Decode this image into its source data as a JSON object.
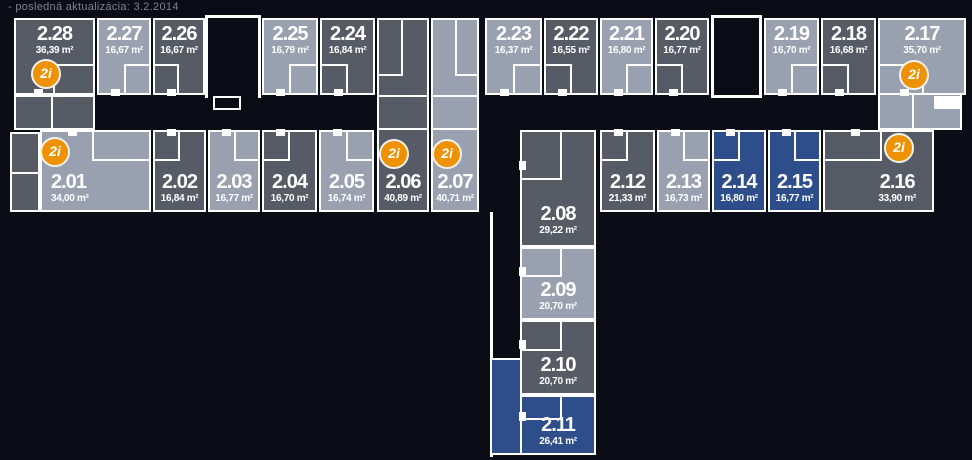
{
  "meta": {
    "last_update": "- posledná aktualizácia: 3.2.2014"
  },
  "badge": {
    "label": "2i"
  },
  "colors": {
    "unit_dark": "#565b66",
    "unit_light": "#99a0af",
    "unit_blue": "#2d4d8b",
    "badge_orange": "#ee9204",
    "walls": "#ffffff",
    "background": "#0a0d15",
    "note_text": "#7e838d"
  },
  "units": {
    "u2_01": {
      "label": "2.01",
      "area": "34,00 m²"
    },
    "u2_02": {
      "label": "2.02",
      "area": "16,84 m²"
    },
    "u2_03": {
      "label": "2.03",
      "area": "16,77 m²"
    },
    "u2_04": {
      "label": "2.04",
      "area": "16,70 m²"
    },
    "u2_05": {
      "label": "2.05",
      "area": "16,74 m²"
    },
    "u2_06": {
      "label": "2.06",
      "area": "40,89 m²"
    },
    "u2_07": {
      "label": "2.07",
      "area": "40,71 m²"
    },
    "u2_08": {
      "label": "2.08",
      "area": "29,22 m²"
    },
    "u2_09": {
      "label": "2.09",
      "area": "20,70 m²"
    },
    "u2_10": {
      "label": "2.10",
      "area": "20,70 m²"
    },
    "u2_11": {
      "label": "2.11",
      "area": "26,41 m²"
    },
    "u2_12": {
      "label": "2.12",
      "area": "21,33 m²"
    },
    "u2_13": {
      "label": "2.13",
      "area": "16,73 m²"
    },
    "u2_14": {
      "label": "2.14",
      "area": "16,80 m²"
    },
    "u2_15": {
      "label": "2.15",
      "area": "16,77 m²"
    },
    "u2_16": {
      "label": "2.16",
      "area": "33,90 m²"
    },
    "u2_17": {
      "label": "2.17",
      "area": "35,70 m²"
    },
    "u2_18": {
      "label": "2.18",
      "area": "16,68 m²"
    },
    "u2_19": {
      "label": "2.19",
      "area": "16,70 m²"
    },
    "u2_20": {
      "label": "2.20",
      "area": "16,77 m²"
    },
    "u2_21": {
      "label": "2.21",
      "area": "16,80 m²"
    },
    "u2_22": {
      "label": "2.22",
      "area": "16,55 m²"
    },
    "u2_23": {
      "label": "2.23",
      "area": "16,37 m²"
    },
    "u2_24": {
      "label": "2.24",
      "area": "16,84 m²"
    },
    "u2_25": {
      "label": "2.25",
      "area": "16,79 m²"
    },
    "u2_26": {
      "label": "2.26",
      "area": "16,67 m²"
    },
    "u2_27": {
      "label": "2.27",
      "area": "16,67 m²"
    },
    "u2_28": {
      "label": "2.28",
      "area": "36,39 m²"
    }
  }
}
